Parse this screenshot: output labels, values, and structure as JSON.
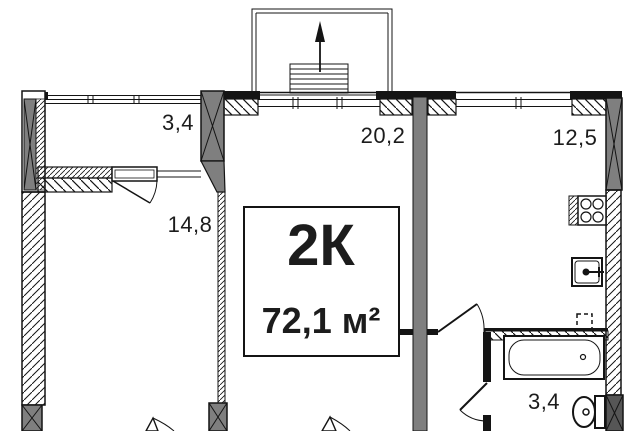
{
  "floor_plan": {
    "unit": {
      "type_label": "2К",
      "area_label": "72,1 м²"
    },
    "rooms": {
      "balcony_top_left": {
        "area": "3,4"
      },
      "living_room": {
        "area": "20,2"
      },
      "kitchen": {
        "area": "12,5"
      },
      "bedroom": {
        "area": "14,8"
      },
      "bathroom": {
        "area": "3,4"
      }
    },
    "fixtures": [
      "escape-ladder",
      "up-arrow",
      "stove",
      "sink",
      "vent-duct",
      "bathtub",
      "toilet"
    ],
    "colors": {
      "wall": "#141414",
      "column_fill": "#7f7f7f",
      "column_dark": "#565656",
      "background": "#ffffff"
    }
  }
}
